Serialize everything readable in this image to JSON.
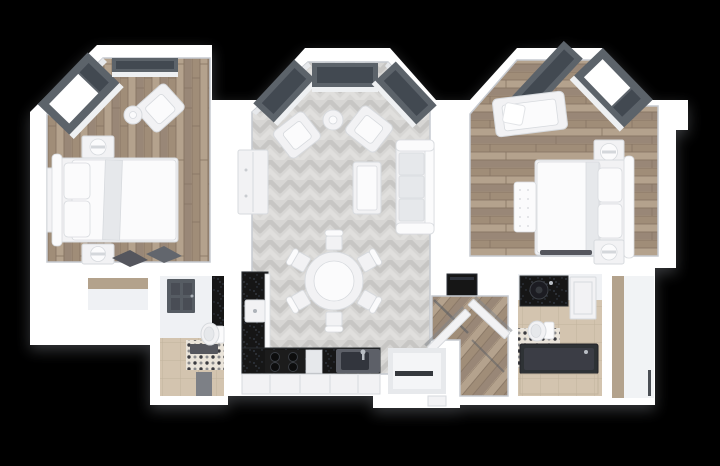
{
  "scene": {
    "title": "3D top-down floor plan render of a two-bedroom apartment",
    "view": "top-down 3D render",
    "background": "#000000"
  },
  "colors": {
    "background": "#000000",
    "wall": "#ffffff",
    "wall_shade": "#e7e9ec",
    "interior": "#eff1f4",
    "floor_outline": "#c6cad0",
    "frame": "#5c636b",
    "glass_white": "#ffffff",
    "glass_dark": "#424851",
    "sill": "#eef0f2",
    "furn_white": "#f2f2f4",
    "furn_bright": "#fbfbfc",
    "furn_shadow": "#e6e8eb",
    "furn_line": "#d7dade",
    "steel": "#5d6167",
    "basin": "#33363c",
    "tub_dark": "#2e3136",
    "door_dark": "#565b63",
    "door_panel": "#484d55",
    "rug_dark": "#54575d",
    "rug_gray": "#7d8086",
    "wood_wall": "#b3a28c",
    "counter_black": "#131419",
    "speck_dot": "#3a3f48",
    "wood_1": "#a08d78",
    "wood_2": "#b4a28d",
    "wood_3": "#998777",
    "wood_line": "#857361",
    "herr_base": "#d7d6d4",
    "herr_dark": "#c7c6c4",
    "herr_light": "#e0dfdd",
    "mosaic_base": "#eae4da",
    "mosaic_dot": "#3b3b3f",
    "mosaic_gray": "#8b8b8d",
    "tile_beige": "#d3c4af",
    "tile_line": "#c2b39d"
  },
  "rooms": [
    {
      "id": "bedroom-left",
      "label": "Bedroom 1",
      "floor": "wood planks",
      "furniture": [
        "double bed",
        "2 nightstands",
        "armchair",
        "round side table",
        "wall console",
        "bay window",
        "slipper rug"
      ]
    },
    {
      "id": "living-dining",
      "label": "Living / Dining Room",
      "floor": "herringbone parquet",
      "furniture": [
        "sofa",
        "2 armchairs",
        "round side table",
        "coffee table",
        "tv sideboard",
        "round dining table",
        "6 dining chairs",
        "3 bay windows"
      ]
    },
    {
      "id": "kitchen",
      "label": "Kitchen",
      "floor": "herringbone parquet",
      "furniture": [
        "L-shaped black counter",
        "cooktop",
        "sink",
        "microwave",
        "fridge"
      ]
    },
    {
      "id": "bedroom-right",
      "label": "Bedroom 2",
      "floor": "wood planks",
      "furniture": [
        "double bed",
        "tufted bench",
        "2 nightstands",
        "loveseat",
        "bay window"
      ]
    },
    {
      "id": "bathroom-left",
      "label": "Bathroom 1",
      "floor": "mosaic and beige tile",
      "furniture": [
        "panel door",
        "black counter",
        "toilet",
        "bath mat",
        "runner rug"
      ]
    },
    {
      "id": "bathroom-right",
      "label": "Bathroom 2",
      "floor": "mosaic and beige tile",
      "furniture": [
        "black vanity with vessel sink",
        "mirror cabinet",
        "toilet",
        "bathtub"
      ]
    },
    {
      "id": "hallway",
      "label": "Hallway",
      "floor": "wood",
      "furniture": [
        "2 open doors"
      ]
    },
    {
      "id": "closet-nook",
      "label": "Closet nook",
      "floor": "wood",
      "furniture": []
    },
    {
      "id": "corridor-right",
      "label": "Utility corridor",
      "floor": "light tile",
      "furniture": []
    },
    {
      "id": "entry",
      "label": "Entry recess",
      "floor": "",
      "furniture": []
    }
  ]
}
